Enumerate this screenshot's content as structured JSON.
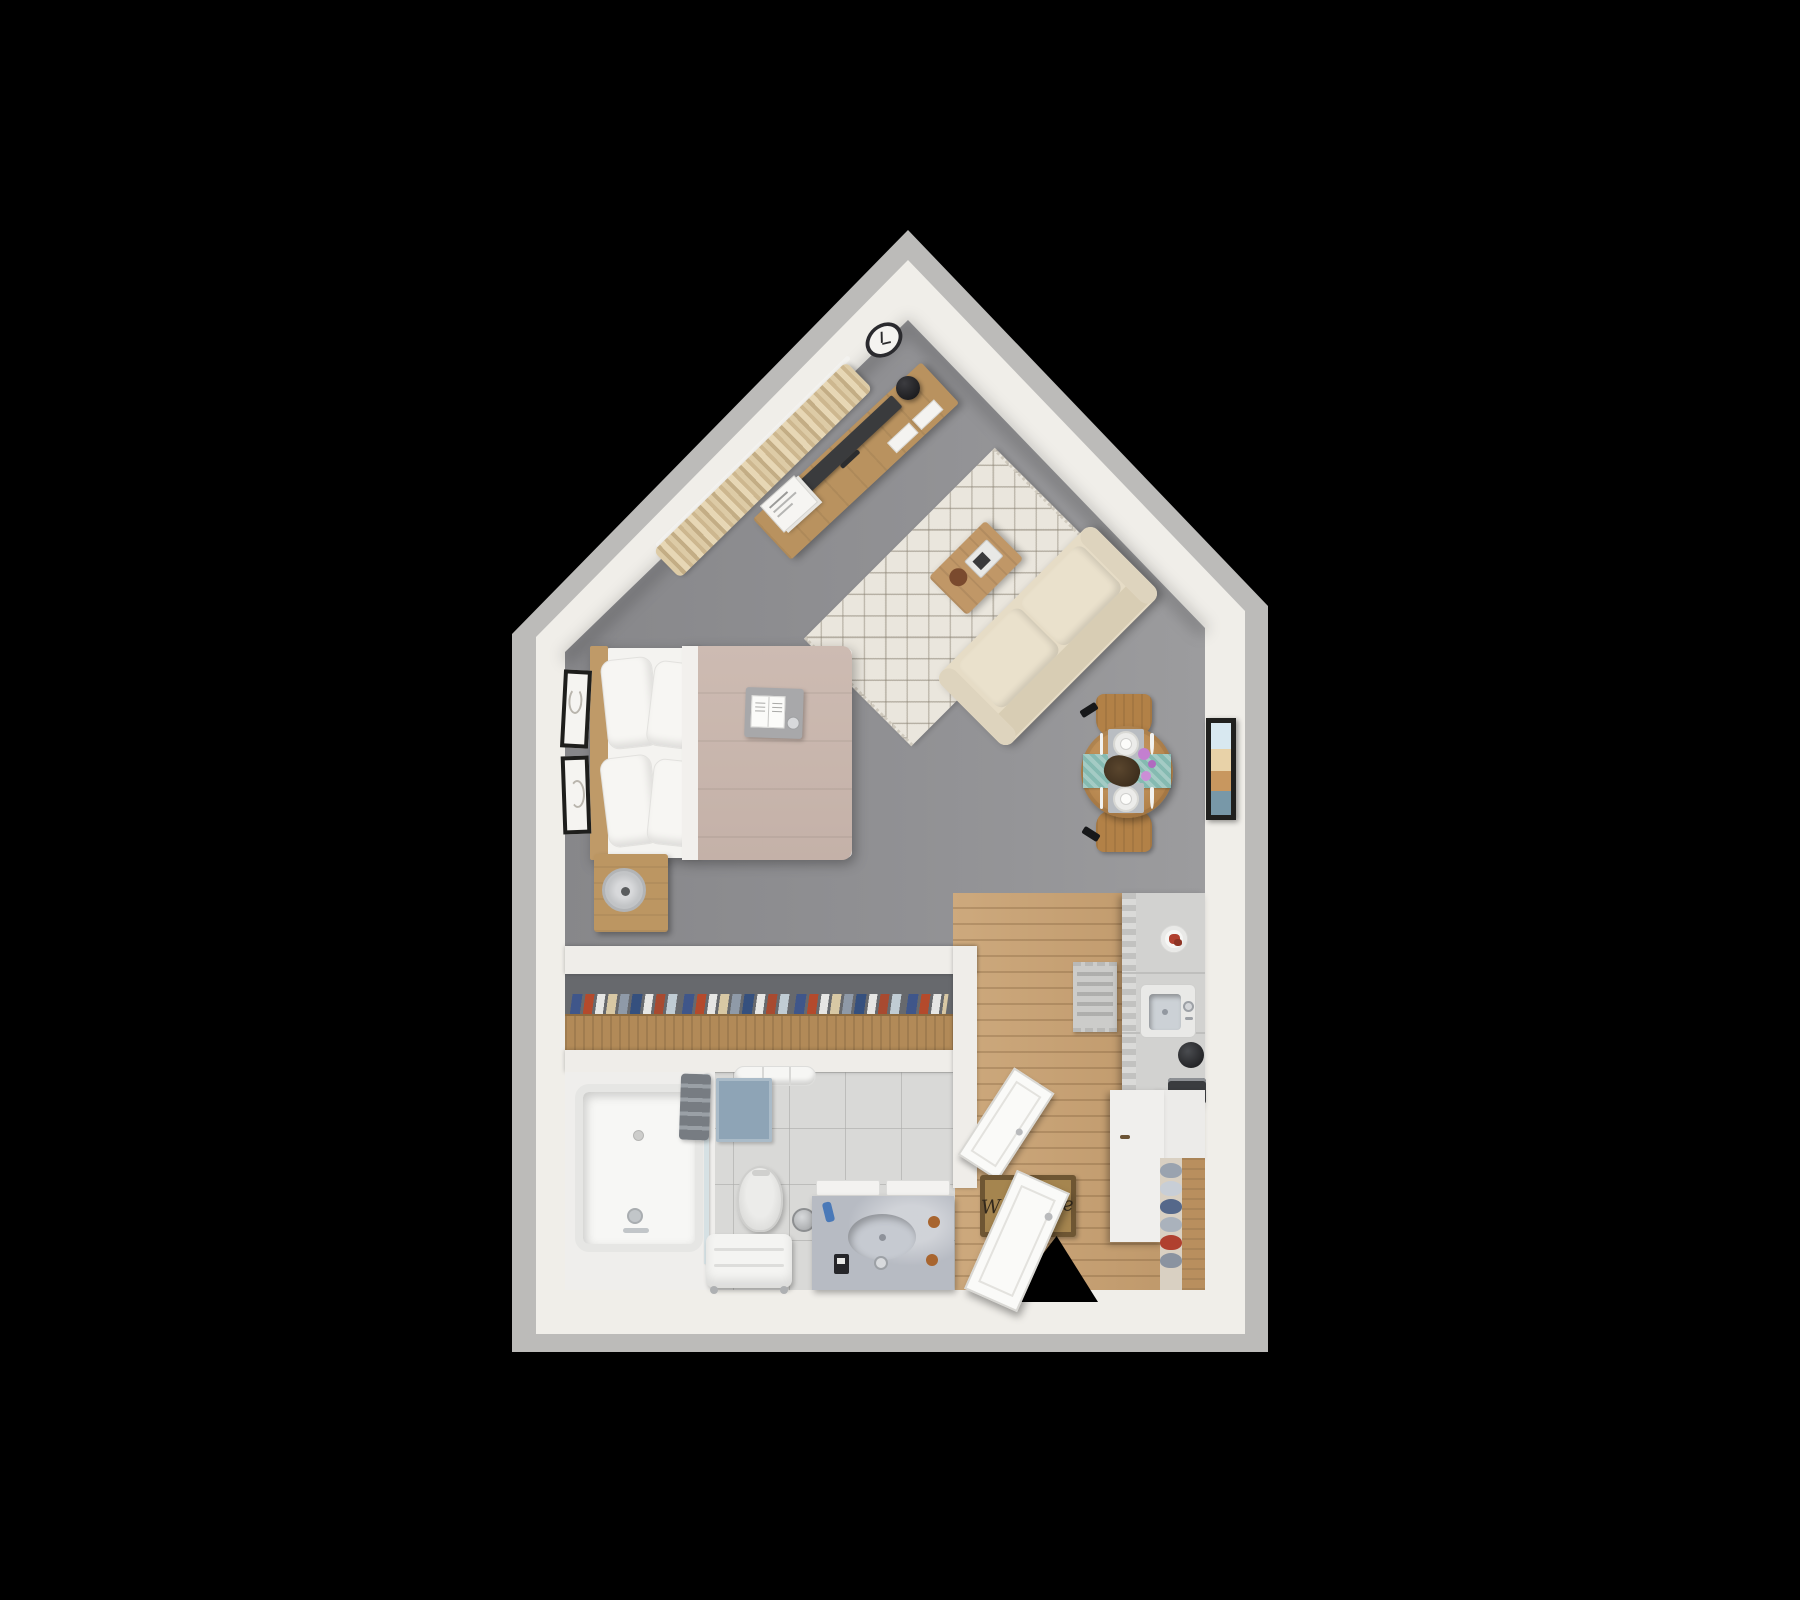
{
  "scene": {
    "title": "Studio apartment 3D floor plan (top-down render)",
    "background_color": "#000000",
    "welcome_mat_text": "Welcome"
  },
  "rooms": [
    {
      "name": "bedroom-living-area",
      "floor": "gray carpet"
    },
    {
      "name": "dining-area",
      "floor": "gray carpet"
    },
    {
      "name": "kitchen-entry",
      "floor": "light wood plank"
    },
    {
      "name": "closet",
      "floor": "recessed niche"
    },
    {
      "name": "bathroom",
      "floor": "light gray tile"
    }
  ],
  "furniture": {
    "bedroom": [
      "double-bed",
      "headboard",
      "four-pillows",
      "taupe-duvet",
      "breakfast-tray-with-book",
      "nightstand",
      "table-fan",
      "two-framed-artworks"
    ],
    "living": [
      "beige-sofa",
      "diamond-pattern-area-rug",
      "wood-coffee-table",
      "serving-tray",
      "decor-bowl",
      "media-console",
      "flat-tv",
      "black-table-lamp",
      "magazines",
      "wall-clock",
      "beige-curtains",
      "curtain-rod"
    ],
    "dining": [
      "round-wood-table",
      "two-wood-chairs",
      "teal-table-runner",
      "two-place-settings",
      "purple-flowers",
      "framed-beach-art"
    ],
    "kitchen": [
      "refrigerator",
      "kitchen-sink",
      "coffee-grinder",
      "coffee-machine",
      "food-plate",
      "base-cabinet",
      "counter"
    ],
    "entry": [
      "welcome-mat",
      "entry-door",
      "patterned-runner-rug",
      "shoe-rack",
      "shoes"
    ],
    "bathroom": [
      "bathtub",
      "glass-screen",
      "gray-towels",
      "towel-rolls",
      "blue-bath-mat",
      "toilet",
      "towel-bench",
      "trash-can",
      "marble-vanity",
      "oval-sink",
      "bathroom-door"
    ],
    "closet": [
      "clothes-rail",
      "hanging-clothes"
    ]
  },
  "palette": {
    "outer_edge": "#bcbbb9",
    "walls": "#f0eee9",
    "floor_gray": "#909092",
    "floor_wood": "#c4a074",
    "floor_tile": "#d9d9d7",
    "closet_interior": "#67696d",
    "rug_cream": "#eae6dd",
    "sofa_beige": "#e6dcc6",
    "duvet_taupe": "#c9b7ae",
    "curtain_beige": "#d9c8a6",
    "furniture_wood": "#b5854e",
    "table_runner_teal": "#85bab1",
    "bath_mat_blue": "#8ea4b6",
    "vanity_marble": "#b7bbc3",
    "welcome_mat_tan": "#a5854f",
    "flowers_purple": "#c37fd0",
    "door_white": "#fafaf8"
  }
}
